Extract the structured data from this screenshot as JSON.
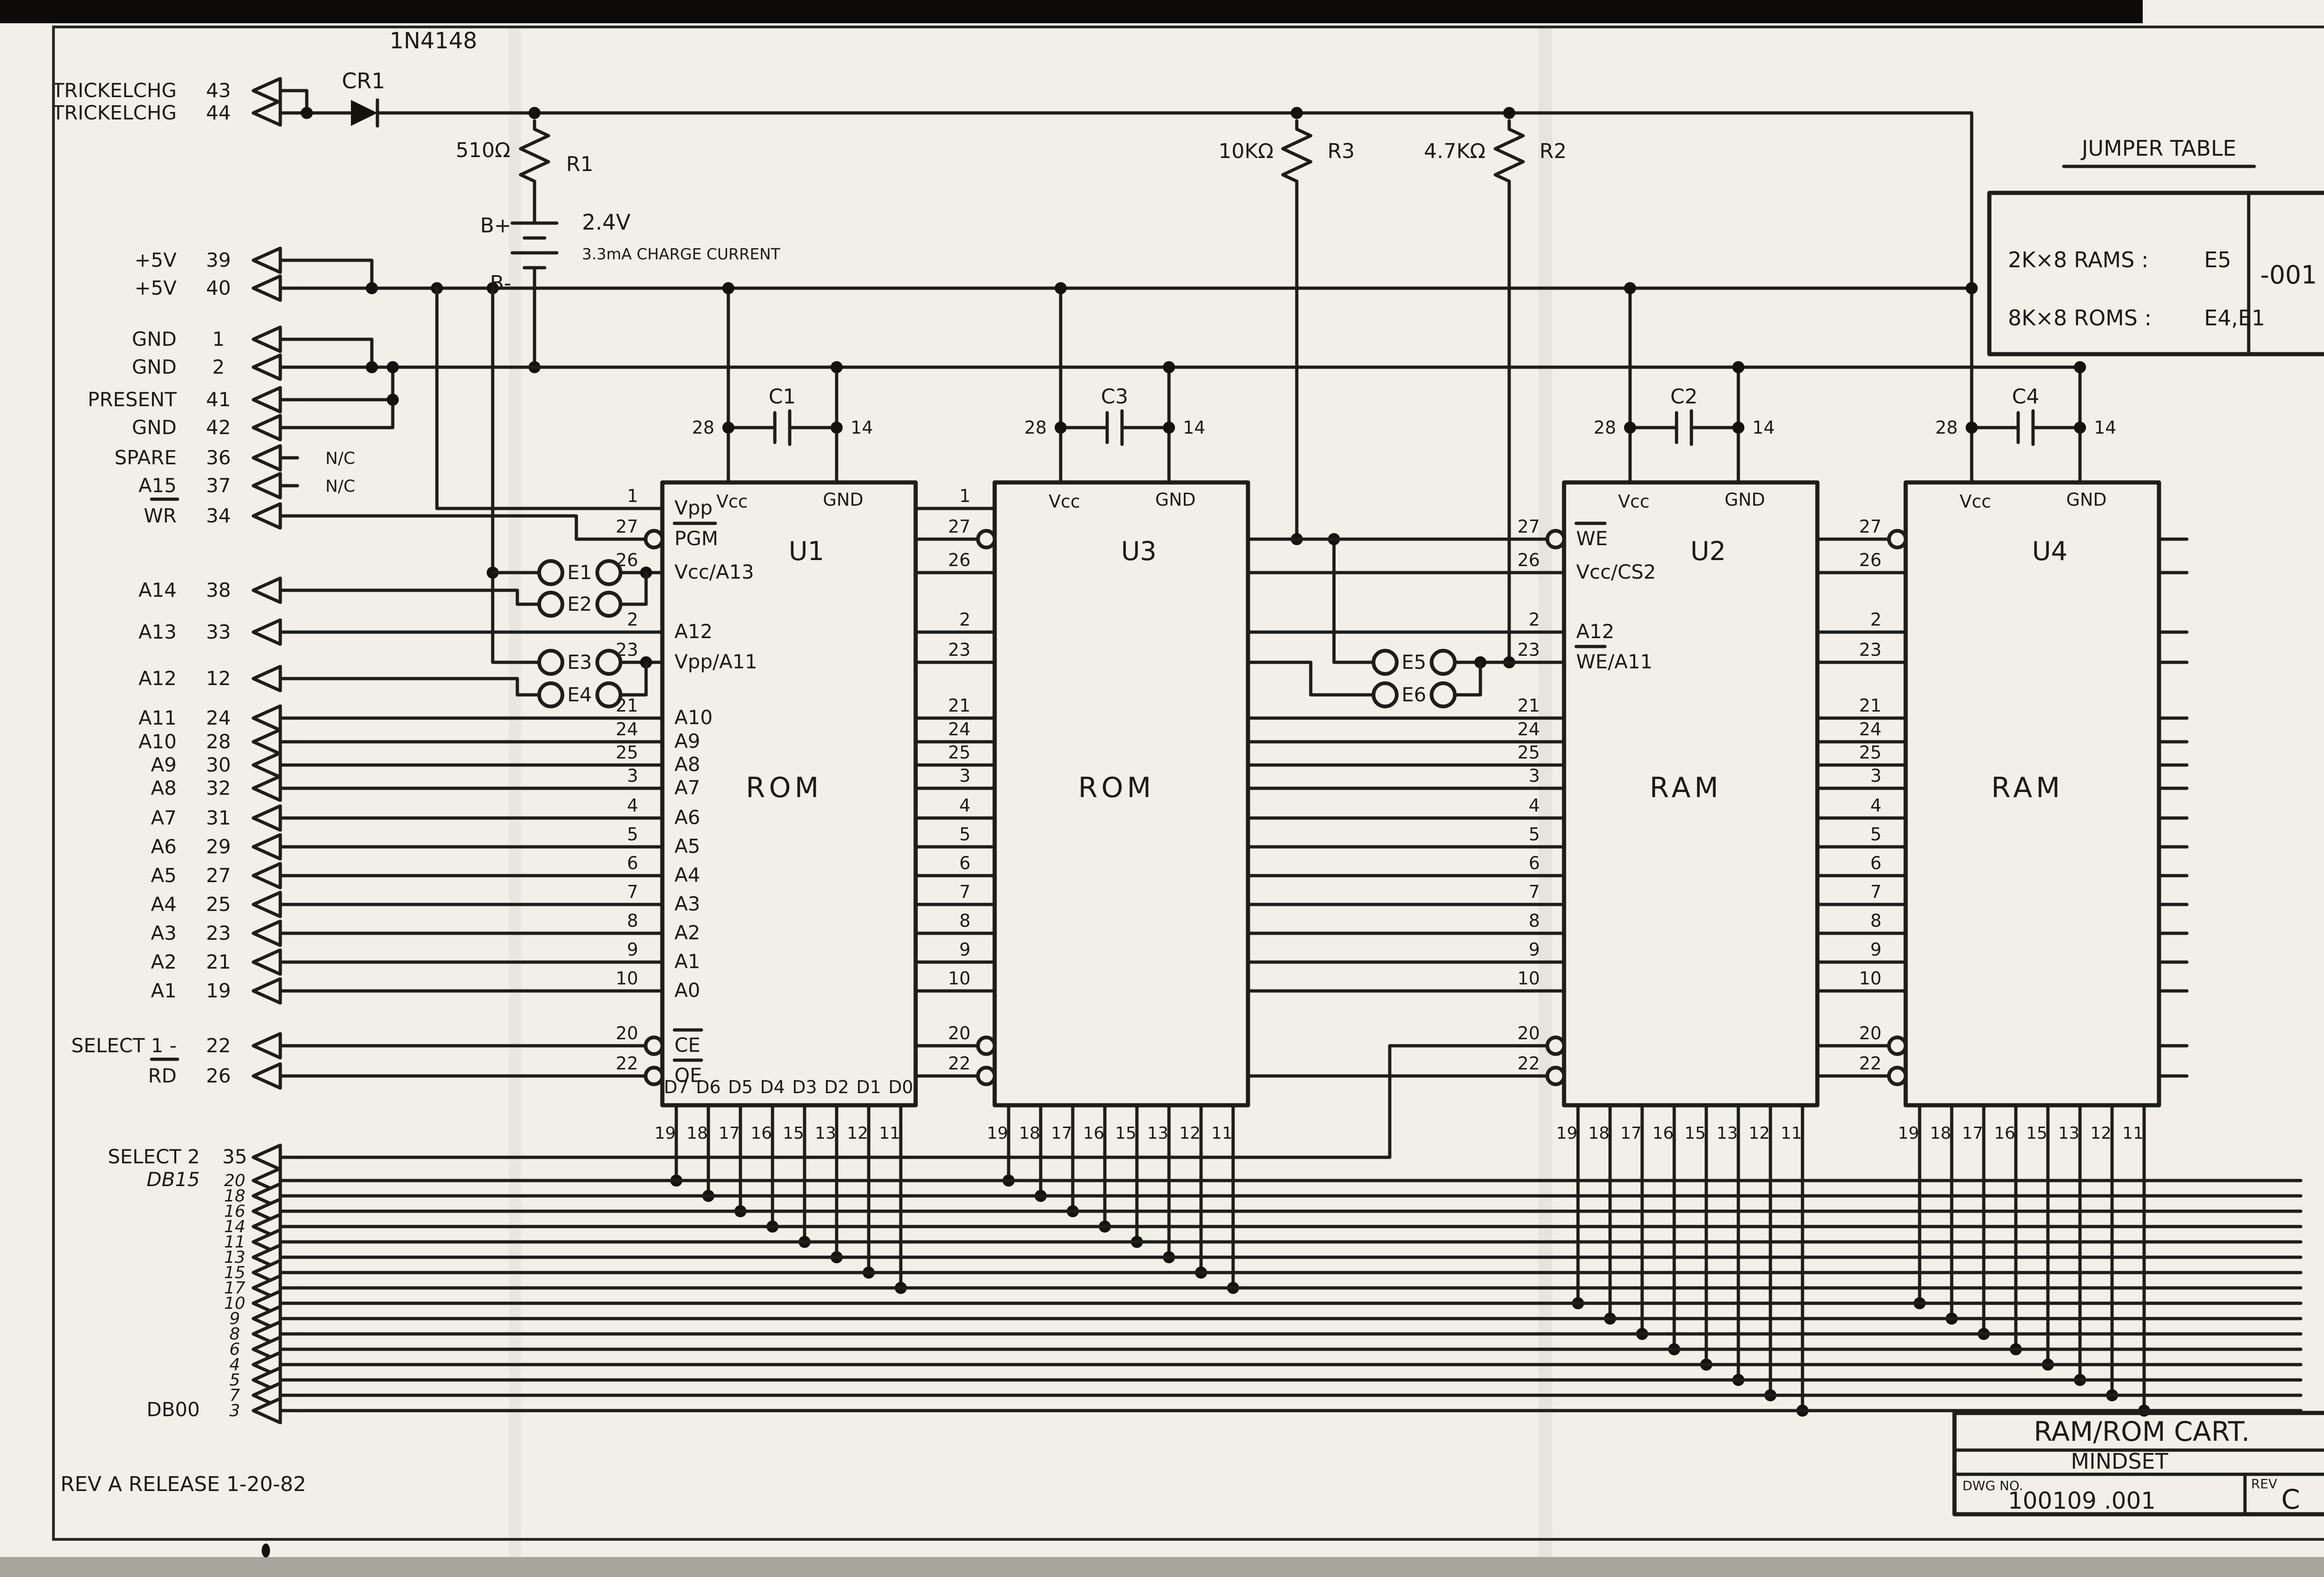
{
  "sheet": {
    "rev_note": "REV A      RELEASE      1-20-82"
  },
  "title_block": {
    "title": "RAM/ROM CART.",
    "company": "MINDSET",
    "dwg_label": "DWG NO.",
    "dwg_no": "100109 .001",
    "rev_label": "REV",
    "rev": "C"
  },
  "jumper_table": {
    "title": "JUMPER TABLE",
    "rows": [
      {
        "label": "2K×8 RAMS :",
        "value": "E5"
      },
      {
        "label": "8K×8 ROMS :",
        "value": "E4,E1"
      }
    ],
    "dash_number": "-001"
  },
  "power": {
    "diode": {
      "ref": "CR1",
      "part": "1N4148"
    },
    "r1": {
      "value": "510Ω",
      "ref": "R1"
    },
    "battery": {
      "plus": "B+",
      "minus": "B-",
      "voltage": "2.4V",
      "note": "3.3mA CHARGE CURRENT"
    },
    "r3": {
      "value": "10KΩ",
      "ref": "R3"
    },
    "r2": {
      "value": "4.7KΩ",
      "ref": "R2"
    }
  },
  "connector": {
    "signals": [
      {
        "label": "TRICKELCHG",
        "pin": "43"
      },
      {
        "label": "TRICKELCHG",
        "pin": "44"
      },
      {
        "label": "+5V",
        "pin": "39"
      },
      {
        "label": "+5V",
        "pin": "40"
      },
      {
        "label": "GND",
        "pin": "1"
      },
      {
        "label": "GND",
        "pin": "2"
      },
      {
        "label": "PRESENT",
        "pin": "41"
      },
      {
        "label": "GND",
        "pin": "42"
      },
      {
        "label": "SPARE",
        "pin": "36",
        "nc": "N/C"
      },
      {
        "label": "A15",
        "pin": "37",
        "nc": "N/C"
      },
      {
        "label": "WR",
        "pin": "34",
        "bar": true
      },
      {
        "label": "A14",
        "pin": "38"
      },
      {
        "label": "A13",
        "pin": "33"
      },
      {
        "label": "A12",
        "pin": "12"
      },
      {
        "label": "A11",
        "pin": "24"
      },
      {
        "label": "A10",
        "pin": "28"
      },
      {
        "label": "A9",
        "pin": "30"
      },
      {
        "label": "A8",
        "pin": "32"
      },
      {
        "label": "A7",
        "pin": "31"
      },
      {
        "label": "A6",
        "pin": "29"
      },
      {
        "label": "A5",
        "pin": "27"
      },
      {
        "label": "A4",
        "pin": "25"
      },
      {
        "label": "A3",
        "pin": "23"
      },
      {
        "label": "A2",
        "pin": "21"
      },
      {
        "label": "A1",
        "pin": "19"
      },
      {
        "label": "SELECT 1 -",
        "pin": "22"
      },
      {
        "label": "RD",
        "pin": "26",
        "bar": true
      }
    ]
  },
  "bus": {
    "select2": {
      "label": "SELECT 2",
      "pin": "35"
    },
    "db_top": {
      "label": "DB15"
    },
    "db_bottom": {
      "label": "DB00"
    },
    "db_pins": [
      "20",
      "18",
      "16",
      "14",
      "11",
      "13",
      "15",
      "17",
      "10",
      "9",
      "8",
      "6",
      "4",
      "5",
      "7",
      "3"
    ]
  },
  "chips": [
    {
      "ref": "U1",
      "type": "ROM"
    },
    {
      "ref": "U3",
      "type": "ROM"
    },
    {
      "ref": "U2",
      "type": "RAM"
    },
    {
      "ref": "U4",
      "type": "RAM"
    }
  ],
  "pin_rows": {
    "pins": [
      "1",
      "27",
      "26",
      "2",
      "23",
      "21",
      "24",
      "25",
      "3",
      "4",
      "5",
      "6",
      "7",
      "8",
      "9",
      "10",
      "20",
      "22"
    ],
    "rom_labels": [
      "Vpp",
      "PGM",
      "Vcc/A13",
      "A12",
      "Vpp/A11",
      "A10",
      "A9",
      "A8",
      "A7",
      "A6",
      "A5",
      "A4",
      "A3",
      "A2",
      "A1",
      "A0",
      "CE",
      "OE"
    ],
    "ram_labels": [
      "",
      "WE",
      "Vcc/CS2",
      "A12",
      "WE/A11",
      "",
      "",
      "",
      "",
      "",
      "",
      "",
      "",
      "",
      "",
      "",
      "",
      ""
    ]
  },
  "chip_top": {
    "vcc": "Vcc",
    "gnd": "GND",
    "vcc_pin": "28",
    "gnd_pin": "14"
  },
  "caps": [
    {
      "ref": "C1"
    },
    {
      "ref": "C3"
    },
    {
      "ref": "C2"
    },
    {
      "ref": "C4"
    }
  ],
  "jumpers": [
    "E1",
    "E2",
    "E3",
    "E4",
    "E5",
    "E6"
  ],
  "chip_bottom": {
    "d_labels": [
      "D7",
      "D6",
      "D5",
      "D4",
      "D3",
      "D2",
      "D1",
      "D0"
    ],
    "pins": [
      "19",
      "18",
      "17",
      "16",
      "15",
      "13",
      "12",
      "11"
    ]
  }
}
